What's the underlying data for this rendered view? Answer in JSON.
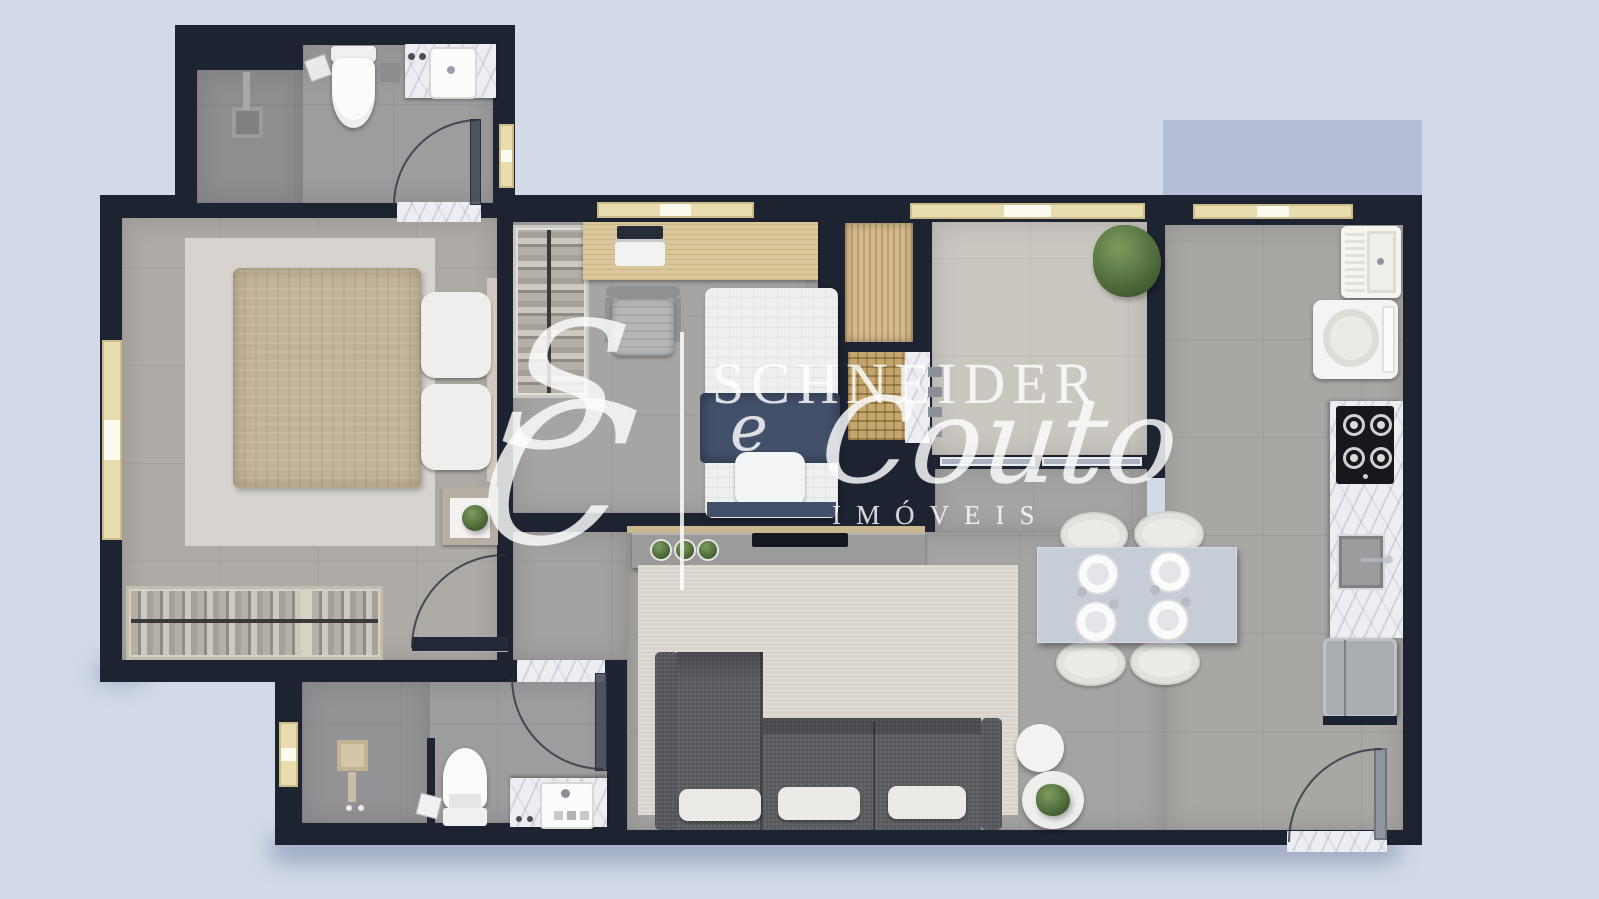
{
  "watermark": {
    "monogram_s": "S",
    "monogram_c": "C",
    "brand_top": "SCHNEIDER",
    "brand_conj": "e",
    "brand_script": "Couto",
    "brand_sub": "IMÓVEIS"
  },
  "palette": {
    "background": "#d2d9e7",
    "wall": "#1d2331",
    "exterior_shadow_block": "#b4bfd5",
    "marble": "#edeef1",
    "window_frame": "#e9ddb0",
    "wood": "#dbc79c",
    "navy_bedding": "#42506a",
    "sofa_charcoal": "#5a5b5f",
    "plant_green": "#55703f",
    "floor_gray": "#a5a4a2",
    "balcony_floor": "#cac6c0"
  },
  "floor_plan": {
    "view": "top-down 3D render of an apartment",
    "rooms": [
      {
        "name": "ensuite-bathroom",
        "items": [
          "walk-in shower",
          "toilet",
          "marble vanity with sink",
          "glass door"
        ]
      },
      {
        "name": "master-bedroom",
        "items": [
          "double bed with beige duvet",
          "area rug",
          "nightstand with plant",
          "open clothes rack",
          "window"
        ]
      },
      {
        "name": "bedroom-2-office",
        "items": [
          "wood desk with laptop",
          "office chair",
          "single bed with navy bedding",
          "open closet rack"
        ]
      },
      {
        "name": "hall-closet",
        "items": [
          "wood wardrobe",
          "woven basket shelf"
        ]
      },
      {
        "name": "balcony",
        "items": [
          "potted plant",
          "sliding glass door"
        ]
      },
      {
        "name": "laundry-nook",
        "items": [
          "wash tub",
          "washing machine"
        ]
      },
      {
        "name": "kitchen",
        "items": [
          "4-burner cooktop",
          "marble counter",
          "sink",
          "refrigerator",
          "entry door"
        ]
      },
      {
        "name": "living-dining",
        "items": [
          "dining table with 4 plates",
          "4 upholstered chairs",
          "L-shaped sofa with white cushions",
          "rug",
          "TV console with plants",
          "round side tables with plant"
        ]
      },
      {
        "name": "bathroom-2",
        "items": [
          "shower",
          "toilet",
          "marble vanity with sink",
          "window"
        ]
      }
    ]
  }
}
